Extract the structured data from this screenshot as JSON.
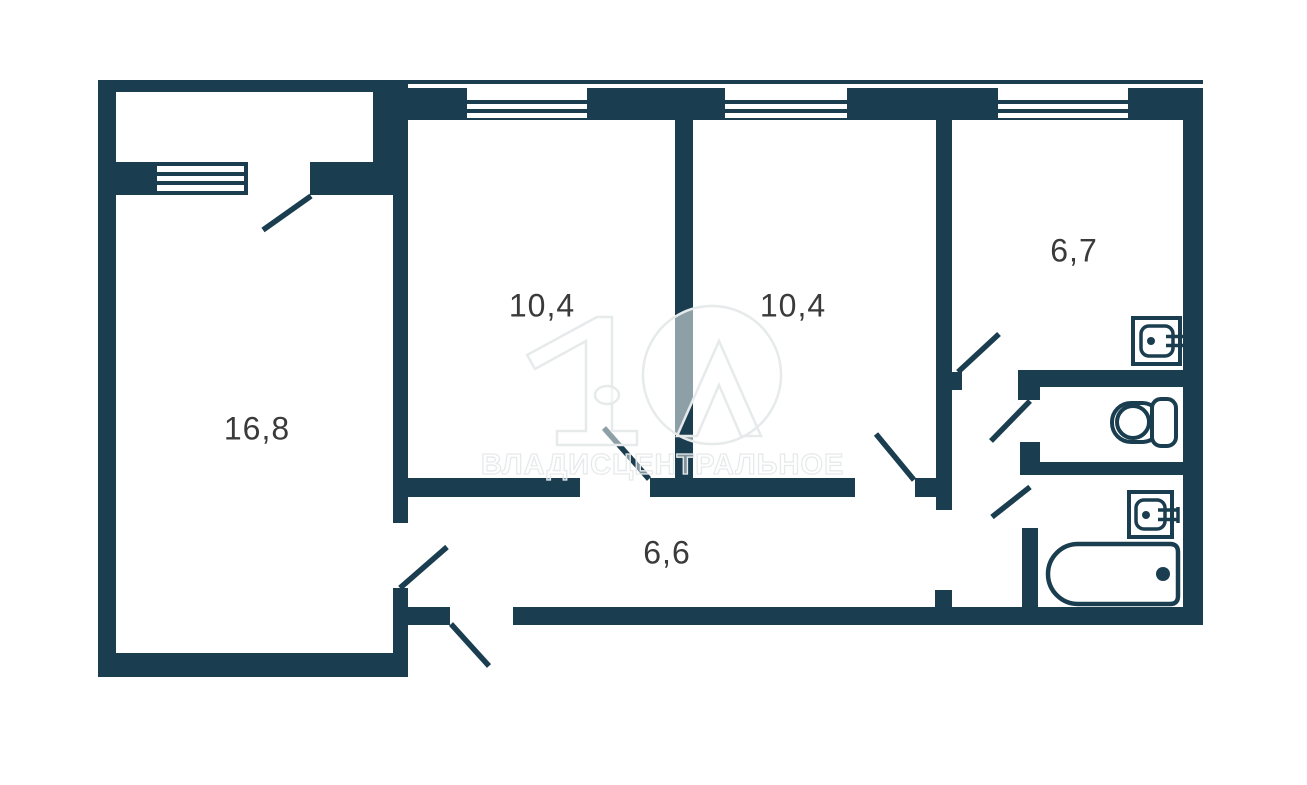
{
  "floorplan": {
    "type": "apartment-floor-plan",
    "rooms": [
      {
        "name": "living-room",
        "area_label": "16,8"
      },
      {
        "name": "bedroom-1",
        "area_label": "10,4"
      },
      {
        "name": "bedroom-2",
        "area_label": "10,4"
      },
      {
        "name": "kitchen",
        "area_label": "6,7"
      },
      {
        "name": "corridor",
        "area_label": "6,6"
      }
    ],
    "fixtures": [
      "kitchen-sink",
      "toilet",
      "bathroom-sink",
      "bathtub"
    ],
    "watermark": {
      "text": "ВЛАДИСЦЕНТРАЛЬНОЕ"
    },
    "colors": {
      "wall": "#1a3e4f",
      "label": "#3a3a3a",
      "watermark": "#e7eaeb",
      "background": "#ffffff"
    }
  }
}
